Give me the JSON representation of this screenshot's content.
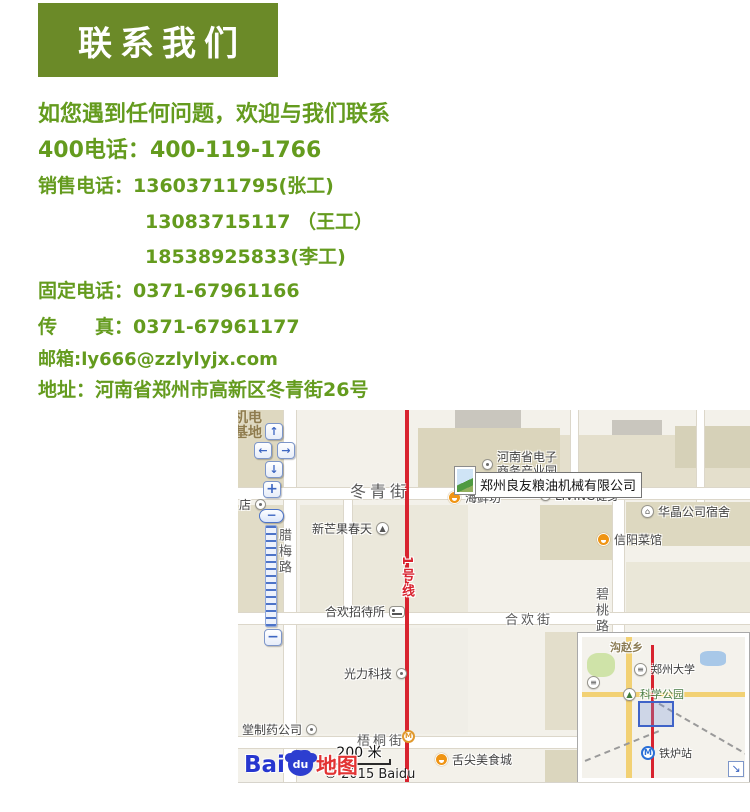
{
  "colors": {
    "header_bg": "#6b8a28",
    "text_green": "#649b1e",
    "metro_red": "#d8232f",
    "viewport_rect_border": "#3f63c8"
  },
  "header": {
    "title": "联系我们"
  },
  "contact": {
    "intro": "如您遇到任何问题，欢迎与我们联系",
    "lines": [
      {
        "label": "400电话：",
        "value": "400-119-1766"
      },
      {
        "label": "销售电话：",
        "value": "13603711795(张工)"
      },
      {
        "label": "",
        "value": "13083715117 （王工）"
      },
      {
        "label": "",
        "value": "18538925833(李工)"
      },
      {
        "label": "固定电话：",
        "value": "0371-67961166"
      },
      {
        "label": "传　　真：",
        "value": "0371-67961177"
      },
      {
        "label": "邮箱:",
        "value": "ly666@zzlylyjx.com"
      },
      {
        "label": "地址：",
        "value": "河南省郑州市高新区冬青街26号"
      }
    ]
  },
  "map": {
    "company_tooltip": "郑州良友粮油机械有限公司",
    "areas": {
      "jidian_jidi": "机电基地",
      "dian": "店"
    },
    "streets": {
      "dongqing": "冬青街",
      "lamei": "腊梅路",
      "bitao": "碧桃路",
      "hehuan": "合欢街",
      "wutong": "梧桐街",
      "line1": "1号线"
    },
    "pois": {
      "ep_park_line1": "河南省电子",
      "ep_park_line2": "商务产业园",
      "haixianfang": "海鲜坊",
      "living": "LIVING健身",
      "huajing": "华晶公司宿舍",
      "xinyang": "信阳菜馆",
      "xinmangguo": "新芒果春天",
      "hehuan_hotel": "合欢招待所",
      "guangli": "光力科技",
      "pharma": "堂制药公司",
      "shejian": "舌尖美食城"
    },
    "scale_text": "200 米",
    "copyright": "© 2015 Baidu",
    "logo": {
      "bai": "Bai",
      "du": "du",
      "ditu": "地图"
    },
    "minimap": {
      "gouzhaoxiang": "沟赵乡",
      "zhengzhou_univ": "郑州大学",
      "kexue_park": "科学公园",
      "tielu_station": "铁炉站"
    },
    "icons": {
      "up": "↑",
      "down": "↓",
      "left": "←",
      "right": "→",
      "plus": "+",
      "minus": "−",
      "handle": "−",
      "collapse": "↘",
      "mountain": "▲",
      "tree": "▲",
      "house": "⌂",
      "metro": "M",
      "univ": "≡"
    }
  }
}
